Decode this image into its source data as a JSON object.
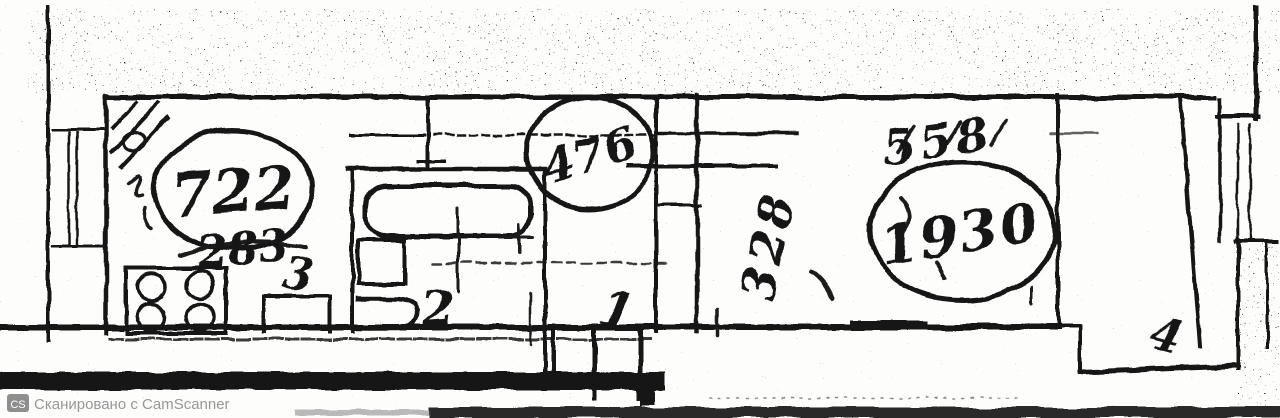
{
  "scan": {
    "watermark_logo": "CS",
    "watermark_text": "Сканировано с CamScanner"
  },
  "plan": {
    "rooms": [
      {
        "name": "kitchen",
        "number": "3"
      },
      {
        "name": "bathroom",
        "number": "2"
      },
      {
        "name": "hallway",
        "number": "1"
      },
      {
        "name": "balcony",
        "number": "4"
      }
    ],
    "measurements": {
      "kitchen_circled": "722",
      "kitchen_crossed": "283",
      "duct_circled": "476",
      "room_rotated": "328",
      "room_upper": "558",
      "room_circled": "1930"
    },
    "colors": {
      "ink": "#141414",
      "paper": "#fdfdfc",
      "watermark_gray": "#979797"
    }
  }
}
